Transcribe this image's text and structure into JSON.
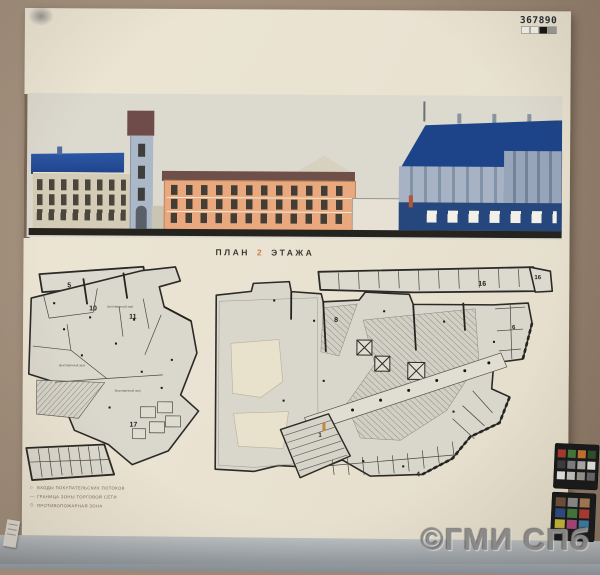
{
  "photo": {
    "catalog_number": "367890",
    "watermark_text": "©ГМИ СПб"
  },
  "grayscale_strip": [
    "#f2f1ec",
    "#f2f1ec",
    "#141414",
    "#9a9a95"
  ],
  "title": {
    "plan": "ПЛАН",
    "floor_number": "2",
    "etazha": "ЭТАЖА"
  },
  "legend": {
    "items": [
      {
        "marker": "○",
        "text": "ВХОДЫ ПОКУПАТЕЛЬСКИХ ПОТОКОВ"
      },
      {
        "marker": "—",
        "text": "ГРАНИЦА ЗОНЫ ТОРГОВОЙ СЕТИ"
      },
      {
        "marker": "◇",
        "text": "ПРОТИВОПОЖАРНАЯ ЗОНА"
      }
    ]
  },
  "plans": {
    "left": {
      "labels": [
        {
          "text": "5"
        },
        {
          "text": "10"
        },
        {
          "text": "11"
        },
        {
          "text": "17"
        }
      ],
      "annotations": [
        {
          "text": "(выставочный зал)"
        },
        {
          "text": "(выставочный зал)"
        },
        {
          "text": "(выставочный зал)"
        }
      ]
    },
    "right": {
      "labels": [
        {
          "text": "16"
        },
        {
          "text": "16"
        },
        {
          "text": "8"
        },
        {
          "text": "6"
        },
        {
          "text": "1"
        },
        {
          "text": "4"
        }
      ]
    }
  },
  "color_checker": {
    "top": [
      "#a93a2e",
      "#45783a",
      "#c8742c",
      "#2f4e2e",
      "#3c3c3e",
      "#808082",
      "#aeaeac",
      "#e6e6e2",
      "#e6e6e2",
      "#c4c4c0",
      "#96968f",
      "#68686a"
    ],
    "bottom": [
      "#6e4f3a",
      "#8c8c8c",
      "#a87c54",
      "#2c4a86",
      "#3f7a3a",
      "#b03a30",
      "#c8b83a",
      "#a8467e",
      "#3a7ea8"
    ]
  },
  "colors": {
    "cardboard": "#9c8977",
    "paper": "#e9e2d1",
    "floor_strip": "#9aa0a5",
    "roof_blue": "#24509b",
    "facade_orange": "#e9a87d",
    "accent_orange_digit": "#c06a28",
    "elevation_background": "#dcd9ce"
  }
}
